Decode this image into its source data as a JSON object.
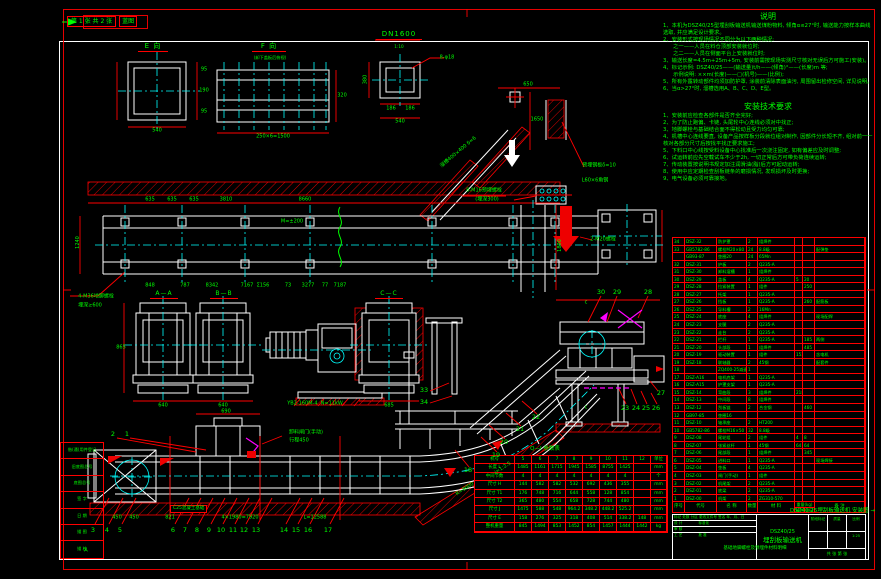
{
  "sheet": {
    "corner_text": "第 1 张  共 2 张",
    "corner_box": "蓝图"
  },
  "views": {
    "e_label": "E 向",
    "f_label": "F 向",
    "f_sub": "(卸下盖板后俯视)",
    "dn_label": "DN1600",
    "dn_scale": "1:10",
    "aa_label": "A—A",
    "bb_label": "B—B",
    "cc_label": "C—C"
  },
  "notes": {
    "title": "说明",
    "items": [
      "1、本机为DSZ40/25型埋刮板输送机输送煤粉物料, 倾角α≤27°时, 输送能力按样本曲线选取, 并应满足设计要求。",
      "2、安装形式按现场情况不同分为以下两种情况:",
      "      之一——人员在料仓顶部安装就位时;",
      "      之二——人员在侧面平台上安装就位时;",
      "3、输送长度=4.5m+25m+5m, 安装前需按现场实测尺寸核对无误后方可施工(安装)。",
      "4、标记示例: DSZ40/25——(输送量)t/h——(倾角)°——(长度)m 等;",
      "      示例说明: ××m(长度)——□(机号)——(比例);",
      "5、所有外露转动部件均须加防护罩, 涂装前清除表面油污, 周围留出检修空间, 详见说明。",
      "6、当α>27°时, 溜槽选用A、B、C、D、E型。"
    ]
  },
  "install": {
    "title": "安装技术要求",
    "items": [
      "1、安装前应检查各部件是否齐全完好;",
      "2、为了防止跑偏、卡链, 头尾轮中心连线必须对中找正;",
      "3、地脚螺栓与基础结合面不得松动且受力均匀可靠;",
      "4、机槽中心连线要直, 设备产品按样板分段就位组对制作, 因部件分长短不齐, 组对前一一核对各部分尺寸后按找平找正要求施工;",
      "5、下料口中心线按受料设备中心找准后一次浇注固定, 如有偏差应及时调整;",
      "6、试运转前应先空载试车不少于2h, 一切正常后方可带负荷连续运转;",
      "7、传动装置按说明书规定加注润滑油(脂)后方可起动运转;",
      "8、使用中应定期检查刮板链条的磨损情况, 发现损坏及时更换;",
      "9、电气设备必须可靠接地。"
    ]
  },
  "bom": {
    "header": {
      "no": "序号",
      "code": "代号",
      "name": "名 称",
      "qty": "数量",
      "mat": "材 料",
      "weight": "重量(kg)",
      "each": "单件",
      "total": "总计",
      "remark": "备 注"
    },
    "rows": [
      {
        "no": "34",
        "code": "DSZ-32",
        "name": "防护罩",
        "qty": "2",
        "mat": "组焊件",
        "w1": "",
        "w2": "",
        "rem": ""
      },
      {
        "no": "33",
        "code": "GB5782-86",
        "name": "螺栓M20×80",
        "qty": "24",
        "mat": "8.8级",
        "w1": "",
        "w2": "",
        "rem": "配弹垫"
      },
      {
        "no": "",
        "code": "GB93-87",
        "name": "垫圈20",
        "qty": "24",
        "mat": "65Mn",
        "w1": "",
        "w2": "",
        "rem": ""
      },
      {
        "no": "32",
        "code": "DSZ-31",
        "name": "护板",
        "qty": "2",
        "mat": "Q235-A",
        "w1": "",
        "w2": "",
        "rem": ""
      },
      {
        "no": "31",
        "code": "DSZ-30",
        "name": "卸料溜槽",
        "qty": "1",
        "mat": "组焊件",
        "w1": "",
        "w2": "",
        "rem": ""
      },
      {
        "no": "30",
        "code": "DSZ-29",
        "name": "盖板",
        "qty": "4",
        "mat": "Q235-A",
        "w1": "5",
        "w2": "20",
        "rem": ""
      },
      {
        "no": "29",
        "code": "DSZ-28",
        "name": "拉紧装置",
        "qty": "1",
        "mat": "组件",
        "w1": "",
        "w2": "250",
        "rem": ""
      },
      {
        "no": "28",
        "code": "DSZ-27",
        "name": "托架",
        "qty": "1",
        "mat": "Q235-A",
        "w1": "",
        "w2": "",
        "rem": ""
      },
      {
        "no": "27",
        "code": "DSZ-26",
        "name": "挡板",
        "qty": "1",
        "mat": "Q235-A",
        "w1": "",
        "w2": "260",
        "rem": "配筋板"
      },
      {
        "no": "26",
        "code": "DSZ-25",
        "name": "导料槽",
        "qty": "2",
        "mat": "16Mn",
        "w1": "",
        "w2": "",
        "rem": ""
      },
      {
        "no": "25",
        "code": "DSZ-24",
        "name": "底座",
        "qty": "4",
        "mat": "组焊件",
        "w1": "",
        "w2": "",
        "rem": "现场配焊"
      },
      {
        "no": "24",
        "code": "DSZ-23",
        "name": "支腿",
        "qty": "2",
        "mat": "Q235-A",
        "w1": "",
        "w2": "",
        "rem": ""
      },
      {
        "no": "23",
        "code": "DSZ-22",
        "name": "走台",
        "qty": "2",
        "mat": "Q235-A",
        "w1": "",
        "w2": "",
        "rem": ""
      },
      {
        "no": "22",
        "code": "DSZ-21",
        "name": "栏杆",
        "qty": "1",
        "mat": "Q235-A",
        "w1": "",
        "w2": "185",
        "rem": "两侧"
      },
      {
        "no": "21",
        "code": "DSZ-20",
        "name": "头部段",
        "qty": "1",
        "mat": "组焊件",
        "w1": "",
        "w2": "485",
        "rem": ""
      },
      {
        "no": "20",
        "code": "DSZ-19",
        "name": "驱动装置",
        "qty": "1",
        "mat": "组件",
        "w1": "1525",
        "w2": "",
        "rem": "含电机"
      },
      {
        "no": "19",
        "code": "DSZ-18",
        "name": "联轴器",
        "qty": "2",
        "mat": "45钢",
        "w1": "",
        "w2": "",
        "rem": "配套件"
      },
      {
        "no": "18",
        "code": "",
        "name": "ZQ400-25减速机",
        "qty": "1",
        "mat": "",
        "w1": "",
        "w2": "",
        "rem": ""
      },
      {
        "no": "17",
        "code": "DSZ-A16",
        "name": "电机底架",
        "qty": "1",
        "mat": "Q235-A",
        "w1": "",
        "w2": "",
        "rem": ""
      },
      {
        "no": "16",
        "code": "DSZ-A15",
        "name": "护罩支架",
        "qty": "1",
        "mat": "Q235-A",
        "w1": "",
        "w2": "",
        "rem": ""
      },
      {
        "no": "15",
        "code": "DSZ-14",
        "name": "弯曲段",
        "qty": "3",
        "mat": "组焊件",
        "w1": "218",
        "w2": "",
        "rem": ""
      },
      {
        "no": "14",
        "code": "DSZ-13",
        "name": "中间段",
        "qty": "8",
        "mat": "组焊件",
        "w1": "",
        "w2": "",
        "rem": ""
      },
      {
        "no": "13",
        "code": "DSZ-12",
        "name": "刮板链",
        "qty": "2",
        "mat": "合金钢",
        "w1": "",
        "w2": "460",
        "rem": ""
      },
      {
        "no": "12",
        "code": "GB97-85",
        "name": "垫圈16",
        "qty": "",
        "mat": "",
        "w1": "",
        "w2": "",
        "rem": ""
      },
      {
        "no": "11",
        "code": "DSZ-10",
        "name": "轴承座",
        "qty": "2",
        "mat": "HT200",
        "w1": "",
        "w2": "",
        "rem": ""
      },
      {
        "no": "10",
        "code": "GB5782-86",
        "name": "螺栓M16×50",
        "qty": "32",
        "mat": "8.8级",
        "w1": "",
        "w2": "",
        "rem": ""
      },
      {
        "no": "9",
        "code": "DSZ-08",
        "name": "尾轮组",
        "qty": "2",
        "mat": "组件",
        "w1": "4",
        "w2": "8",
        "rem": ""
      },
      {
        "no": "8",
        "code": "DSZ-07",
        "name": "张紧丝杆",
        "qty": "1",
        "mat": "45钢",
        "w1": "64",
        "w2": "64",
        "rem": ""
      },
      {
        "no": "7",
        "code": "DSZ-06",
        "name": "尾部段",
        "qty": "1",
        "mat": "组焊件",
        "w1": "",
        "w2": "345",
        "rem": ""
      },
      {
        "no": "6",
        "code": "DSZ-05",
        "name": "进料口",
        "qty": "1",
        "mat": "Q235-A",
        "w1": "",
        "w2": "",
        "rem": "现场焊接"
      },
      {
        "no": "5",
        "code": "DSZ-04",
        "name": "垫板",
        "qty": "4",
        "mat": "Q235-A",
        "w1": "",
        "w2": "",
        "rem": ""
      },
      {
        "no": "4",
        "code": "DSZ-03",
        "name": "闸门(手动)",
        "qty": "1",
        "mat": "组件",
        "w1": "",
        "w2": "",
        "rem": ""
      },
      {
        "no": "3",
        "code": "DSZ-02",
        "name": "机尾架",
        "qty": "2",
        "mat": "Q235-A",
        "w1": "",
        "w2": "",
        "rem": ""
      },
      {
        "no": "2",
        "code": "DSZ-01",
        "name": "底梁",
        "qty": "2",
        "mat": "Q235-A",
        "w1": "",
        "w2": "",
        "rem": ""
      },
      {
        "no": "1",
        "code": "DSZ-00",
        "name": "机架",
        "qty": "2",
        "mat": "ZG310-570",
        "w1": "",
        "w2": "",
        "rem": ""
      }
    ]
  },
  "param_table": {
    "title": "Q—Ⅰ 参数表",
    "corner": "机号",
    "cols": [
      "5",
      "6",
      "7",
      "8",
      "9",
      "10",
      "11",
      "12",
      "单位"
    ],
    "rows": [
      {
        "name": "长度 L",
        "v": [
          "1485",
          "1161",
          "1715",
          "1945",
          "1585",
          "8755",
          "1425",
          ""
        ],
        "unit": "mm"
      },
      {
        "name": "中间节数",
        "v": [
          "4",
          "4",
          "4",
          "4",
          "4",
          "4",
          "4",
          ""
        ],
        "unit": "个"
      },
      {
        "name": "尺寸 H",
        "v": [
          "144",
          "582",
          "582",
          "532",
          "692",
          "436",
          "355",
          ""
        ],
        "unit": "mm"
      },
      {
        "name": "尺寸 T1",
        "v": [
          "176",
          "748",
          "716",
          "644",
          "558",
          "128",
          "854",
          ""
        ],
        "unit": "mm"
      },
      {
        "name": "尺寸 T2",
        "v": [
          "365",
          "480",
          "554",
          "658",
          "728",
          "744",
          "480",
          ""
        ],
        "unit": "mm"
      },
      {
        "name": "尺寸 J",
        "v": [
          "1475",
          "588",
          "548",
          "964.2",
          "348.2",
          "448.2",
          "525.2",
          ""
        ],
        "unit": "mm"
      },
      {
        "name": "尺寸 E",
        "v": [
          "158",
          "276",
          "325",
          "318",
          "408",
          "514",
          "338.2",
          "148"
        ],
        "unit": "mm"
      },
      {
        "name": "整机重量",
        "v": [
          "845",
          "1494",
          "853",
          "1452",
          "854",
          "1457",
          "1444",
          "1442"
        ],
        "unit": "kg"
      }
    ]
  },
  "title_block": {
    "sign_rows": [
      "标记 处数 分区 更改文件号 签名 年、月、日",
      "设 计              标准化",
      "审 核",
      "工 艺              批 准"
    ],
    "model": "DSZ40/25",
    "name_big": "埋刮板输送机",
    "stage_label": "阶段标记",
    "mass_label": "质量",
    "scale_label": "比例",
    "scale": "1:25",
    "sheets": "共 张  第 张",
    "spill": "DSZ40/25埋刮板输送机 安装图 →",
    "bottom_note": "基础地脚螺栓及预埋件材料明细"
  },
  "left_margin": {
    "rows": [
      "借(通)用件登记",
      "旧底图总号",
      "底图总号",
      "签 字",
      "日 期",
      "描 图",
      "描 校"
    ]
  },
  "ann": {
    "foundation": "C25混凝土基础",
    "rot_1240": "1240",
    "rot_1890": "1890",
    "rot_r9000": "R=9000",
    "rot_i": "i=1:2.5",
    "rot_chute": "溜槽400×400 δ=6",
    "rot_380": "380"
  },
  "labels": [
    {
      "t": "95",
      "x": 204,
      "y": 70
    },
    {
      "t": "190",
      "x": 204,
      "y": 91
    },
    {
      "t": "95",
      "x": 204,
      "y": 112
    },
    {
      "t": "540",
      "x": 157,
      "y": 131
    },
    {
      "t": "250×6=1500",
      "x": 273,
      "y": 137
    },
    {
      "t": "320",
      "x": 342,
      "y": 96
    },
    {
      "t": "8-φ18",
      "x": 447,
      "y": 58
    },
    {
      "t": "186",
      "x": 391,
      "y": 109
    },
    {
      "t": "186",
      "x": 410,
      "y": 109
    },
    {
      "t": "540",
      "x": 400,
      "y": 122
    },
    {
      "t": "635",
      "x": 150,
      "y": 200
    },
    {
      "t": "635",
      "x": 172,
      "y": 200
    },
    {
      "t": "635",
      "x": 194,
      "y": 200
    },
    {
      "t": "3810",
      "x": 226,
      "y": 200
    },
    {
      "t": "8660",
      "x": 305,
      "y": 200
    },
    {
      "t": "M=±200",
      "x": 292,
      "y": 222
    },
    {
      "t": "4-M36地脚螺栓",
      "x": 96,
      "y": 297
    },
    {
      "t": "埋深≥600",
      "x": 90,
      "y": 306
    },
    {
      "t": "848",
      "x": 150,
      "y": 286
    },
    {
      "t": "787",
      "x": 185,
      "y": 286
    },
    {
      "t": "8342",
      "x": 212,
      "y": 286
    },
    {
      "t": "7167",
      "x": 247,
      "y": 286
    },
    {
      "t": "Σ156",
      "x": 263,
      "y": 286
    },
    {
      "t": "73",
      "x": 288,
      "y": 286
    },
    {
      "t": "3277",
      "x": 308,
      "y": 286
    },
    {
      "t": "77",
      "x": 325,
      "y": 286
    },
    {
      "t": "7187",
      "x": 340,
      "y": 286
    },
    {
      "t": "640",
      "x": 163,
      "y": 406
    },
    {
      "t": "640",
      "x": 223,
      "y": 406
    },
    {
      "t": "685",
      "x": 389,
      "y": 406
    },
    {
      "t": "865",
      "x": 121,
      "y": 348
    },
    {
      "t": "YB2-160M-4  N=11kW",
      "x": 315,
      "y": 404
    },
    {
      "t": "650",
      "x": 528,
      "y": 85
    },
    {
      "t": "1650",
      "x": 537,
      "y": 120
    },
    {
      "t": "8-M16预埋螺栓",
      "x": 484,
      "y": 191
    },
    {
      "t": "(埋深300)",
      "x": 487,
      "y": 200
    },
    {
      "t": "预埋钢板δ=10",
      "x": 599,
      "y": 166
    },
    {
      "t": "L60×6角钢",
      "x": 595,
      "y": 181
    },
    {
      "t": "2-M20螺栓",
      "x": 603,
      "y": 240
    },
    {
      "t": "卸料闸门(手动)",
      "x": 306,
      "y": 433
    },
    {
      "t": "行程450",
      "x": 299,
      "y": 441
    },
    {
      "t": "690",
      "x": 226,
      "y": 412
    },
    {
      "t": "450",
      "x": 117,
      "y": 518
    },
    {
      "t": "450",
      "x": 134,
      "y": 518
    },
    {
      "t": "821",
      "x": 170,
      "y": 518
    },
    {
      "t": "4×1980=7920",
      "x": 240,
      "y": 518
    },
    {
      "t": "L=12588",
      "x": 315,
      "y": 518
    },
    {
      "t": "c",
      "x": 586,
      "y": 303
    },
    {
      "t": "c",
      "x": 586,
      "y": 408
    },
    {
      "t": "A",
      "x": 86,
      "y": 551
    }
  ],
  "balloons": [
    {
      "n": "1",
      "x": 127,
      "y": 434
    },
    {
      "n": "2",
      "x": 113,
      "y": 434
    },
    {
      "n": "3",
      "x": 93,
      "y": 530
    },
    {
      "n": "4",
      "x": 107,
      "y": 530
    },
    {
      "n": "5",
      "x": 120,
      "y": 530
    },
    {
      "n": "6",
      "x": 173,
      "y": 530
    },
    {
      "n": "7",
      "x": 185,
      "y": 530
    },
    {
      "n": "8",
      "x": 197,
      "y": 530
    },
    {
      "n": "9",
      "x": 209,
      "y": 530
    },
    {
      "n": "10",
      "x": 221,
      "y": 530
    },
    {
      "n": "11",
      "x": 233,
      "y": 530
    },
    {
      "n": "12",
      "x": 244,
      "y": 530
    },
    {
      "n": "13",
      "x": 256,
      "y": 530
    },
    {
      "n": "14",
      "x": 284,
      "y": 530
    },
    {
      "n": "15",
      "x": 296,
      "y": 530
    },
    {
      "n": "16",
      "x": 308,
      "y": 530
    },
    {
      "n": "17",
      "x": 328,
      "y": 530
    },
    {
      "n": "18",
      "x": 468,
      "y": 470
    },
    {
      "n": "19",
      "x": 496,
      "y": 455
    },
    {
      "n": "20",
      "x": 504,
      "y": 442
    },
    {
      "n": "21",
      "x": 520,
      "y": 429
    },
    {
      "n": "22",
      "x": 536,
      "y": 417
    },
    {
      "n": "23",
      "x": 625,
      "y": 408
    },
    {
      "n": "24",
      "x": 636,
      "y": 408
    },
    {
      "n": "25",
      "x": 646,
      "y": 408
    },
    {
      "n": "26",
      "x": 656,
      "y": 408
    },
    {
      "n": "27",
      "x": 661,
      "y": 393
    },
    {
      "n": "28",
      "x": 648,
      "y": 292
    },
    {
      "n": "29",
      "x": 617,
      "y": 292
    },
    {
      "n": "30",
      "x": 601,
      "y": 292
    },
    {
      "n": "33",
      "x": 424,
      "y": 390
    },
    {
      "n": "34",
      "x": 424,
      "y": 402
    }
  ]
}
